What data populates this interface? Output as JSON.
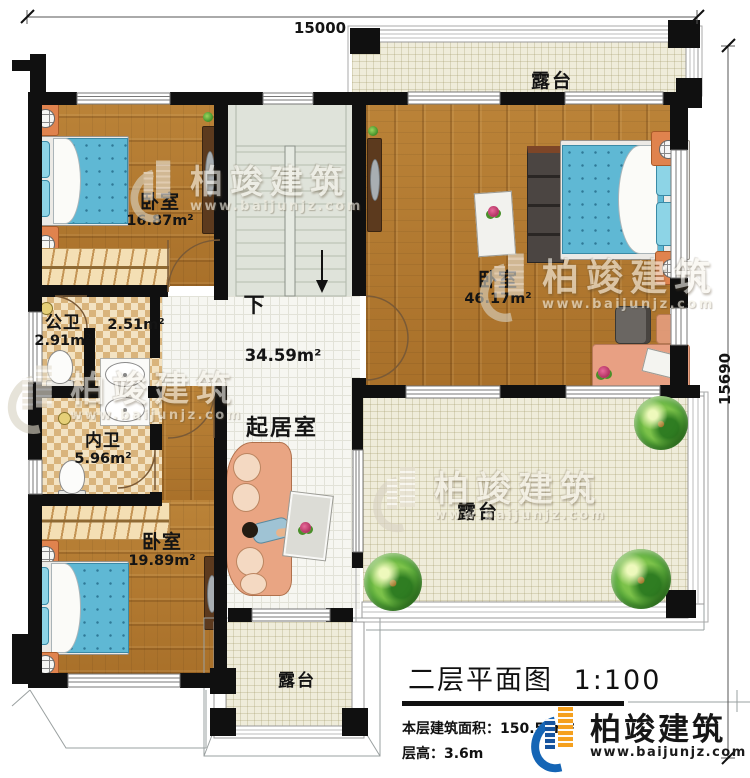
{
  "dimensions": {
    "width_mm": "15000",
    "height_mm": "15690"
  },
  "rooms": {
    "terrace_top": {
      "name": "露台"
    },
    "bedroom_top_left": {
      "name": "卧室",
      "area": "16.87m²"
    },
    "master_bedroom": {
      "name": "卧室",
      "area": "46.17m²"
    },
    "public_bathroom": {
      "name": "公卫",
      "area": "2.91m²"
    },
    "hallway": {
      "area": "2.51m²"
    },
    "private_bathroom": {
      "name": "内卫",
      "area": "5.96m²"
    },
    "living_room": {
      "name": "起居室",
      "area": "34.59m²"
    },
    "stairs": {
      "direction": "下"
    },
    "bedroom_bottom_left": {
      "name": "卧室",
      "area": "19.89m²"
    },
    "terrace_right": {
      "name": "露台"
    },
    "terrace_bottom": {
      "name": "露台"
    }
  },
  "title_block": {
    "title": "二层平面图",
    "scale": "1:100",
    "area_line": "本层建筑面积：150.53m²",
    "floor_height_line": "层高：3.6m"
  },
  "brand": {
    "name": "柏竣建筑",
    "website": "www.baijunjz.com"
  },
  "watermark": {
    "name": "柏竣建筑",
    "website": "www.baijunjz.com"
  },
  "colors": {
    "wall": "#111111",
    "wood_floor": "#b1792f",
    "tile_floor": "#f6f6f1",
    "terrace_floor": "#efecda",
    "bath_checker_dark": "#d9b47c",
    "bath_checker_light": "#f3e3c3",
    "stair_floor": "#dfe3da",
    "bed_blue": "#5fb8d4",
    "furniture_orange": "#e0834e",
    "sofa_salmon": "#e9a583",
    "logo_blue": "#1565b5",
    "logo_orange": "#f5a01e"
  }
}
